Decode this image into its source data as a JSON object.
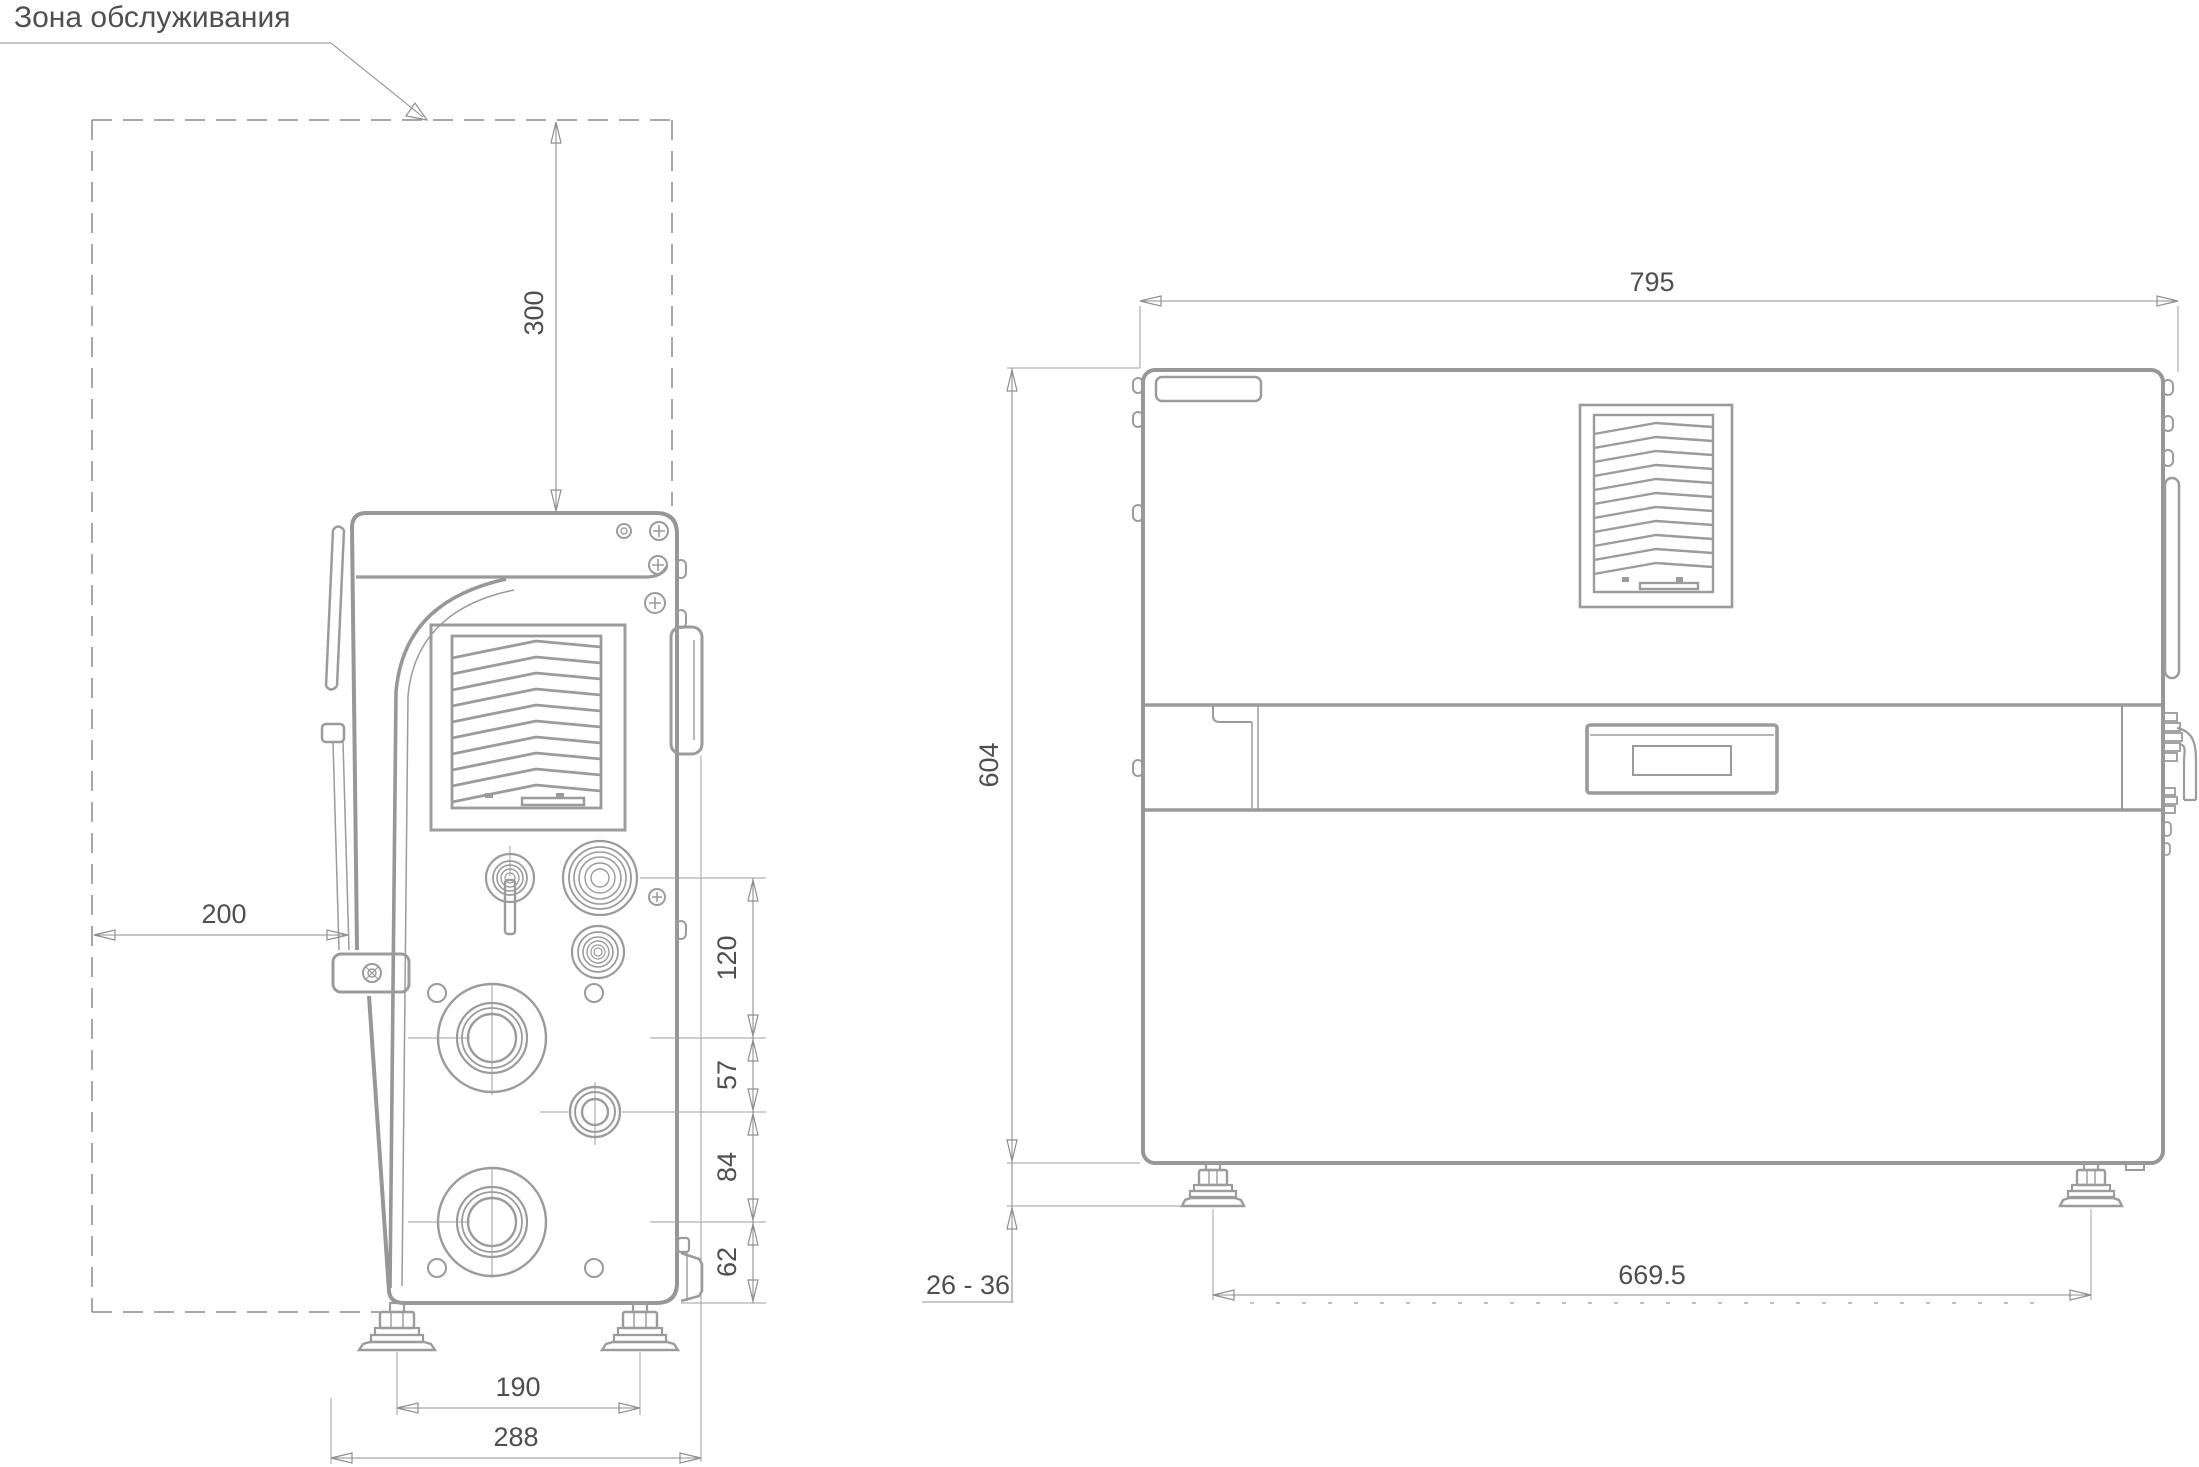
{
  "title": {
    "label": "Зона обслуживания"
  },
  "colors": {
    "outline": "#979797",
    "dimension_line": "#8f8f8f",
    "text": "#4f4f4f",
    "background": "#ffffff"
  },
  "side_view": {
    "description": "left side view of power source with service zone",
    "dims": {
      "top_clearance": "300",
      "rear_clearance": "200",
      "connector_span_1": "120",
      "connector_span_2": "57",
      "connector_span_3": "84",
      "connector_span_4": "62",
      "feet_spacing": "190",
      "overall_depth": "288"
    }
  },
  "front_view": {
    "description": "front view of power source",
    "dims": {
      "overall_width": "795",
      "overall_height": "604",
      "foot_height_range": "26 - 36",
      "feet_spacing": "669.5"
    }
  }
}
